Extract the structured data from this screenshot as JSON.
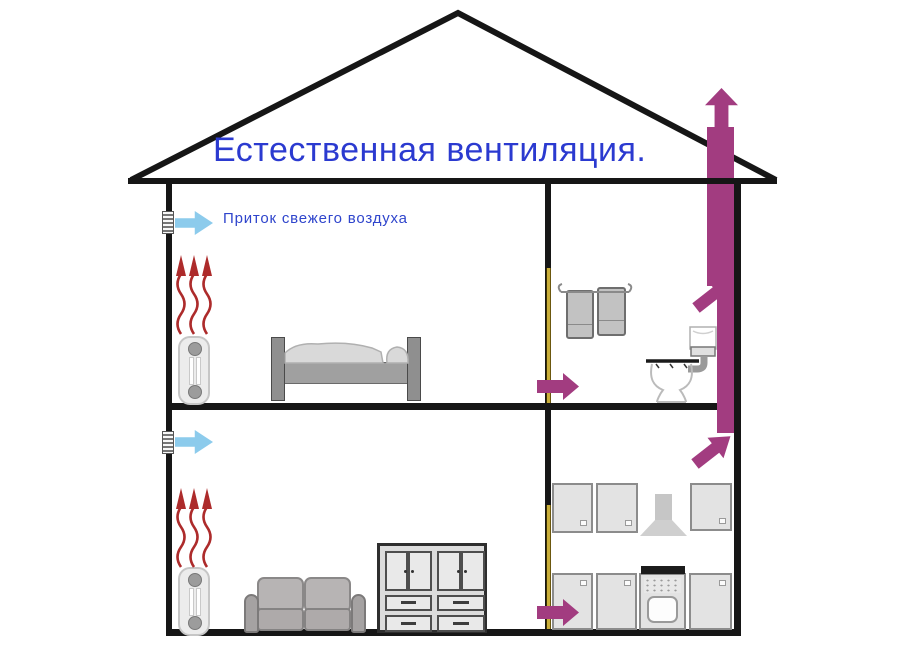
{
  "diagram": {
    "title": "Естественная вентиляция.",
    "supply_label": "Приток свежего воздуха",
    "colors": {
      "title_text": "#2b3ad0",
      "label_text": "#2f45cc",
      "supply_arrow": "#8ccbec",
      "exhaust_arrow": "#a23c80",
      "heat_wave": "#ad2b2b",
      "door_gap": "#c9ae3a",
      "outline": "#161616"
    },
    "icons": {
      "supply_air_arrow": "light blue arrow pointing right through wall vent",
      "wall_vent_grille": "small striped intake grille on left wall",
      "heat_wave_arrows": "three red wavy arrows rising above each radiator",
      "exhaust_duct": "magenta vertical duct exiting through the roof",
      "exhaust_flow_arrow": "magenta arrows showing air flow into and up the duct",
      "door_undercut": "yellow gap strip on inner wall where air passes",
      "radiator": "two-column heater on left wall of each floor",
      "bed": "double bed, upper floor",
      "towels": "two towels on rail, bathroom",
      "toilet": "toilet with high cistern, bathroom",
      "sofa": "two-seat sofa, lower floor",
      "dresser": "cupboard with doors and four drawers, lower floor",
      "kitchen": "wall cabinets, cooker hood, stove and base cabinets"
    }
  }
}
